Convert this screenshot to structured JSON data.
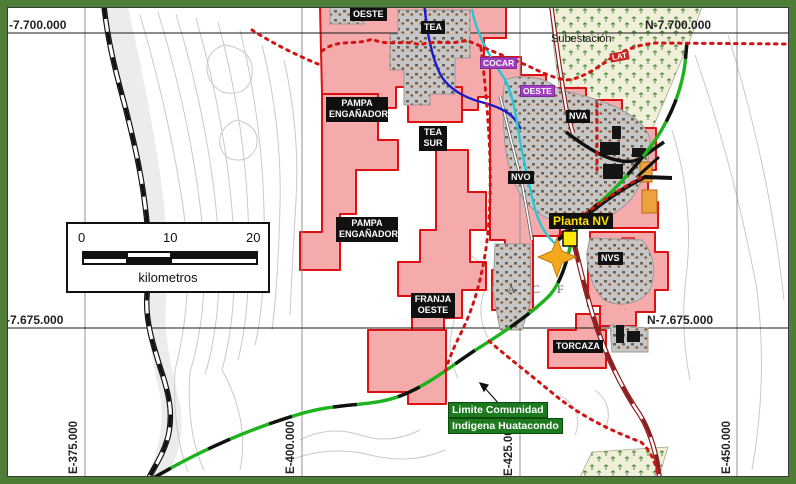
{
  "coordinates": {
    "top_left": "-7.700.000",
    "top_right": "N-7.700.000",
    "mid_left": "-7.675.000",
    "mid_right": "N-7.675.000",
    "east_1": "E-375.000",
    "east_2": "E-400.000",
    "east_3": "E-425.000",
    "east_4": "E-450.000"
  },
  "concessions": {
    "oeste_north": "OESTE",
    "tea": "TEA",
    "cocar": "COCAR",
    "oeste_east": "OESTE",
    "pampa_enganadora_1": "PAMPA ENGAÑADORA",
    "tea_sur": "TEA SUR",
    "pampa_enganadora_2": "PAMPA ENGAÑADORA",
    "franja_oeste": "FRANJA OESTE",
    "nva": "NVA",
    "nvo": "NVO",
    "nvs": "NVS",
    "torcaza": "TORCAZA"
  },
  "places": {
    "bellavista": "BELLAVISTA",
    "subestacion": "Subestación",
    "planta_nv": "Planta NV",
    "lat": "LAT",
    "acf": "A C F"
  },
  "boundary_label": {
    "line1": "Limite Comunidad",
    "line2": "Indigena Huatacondo"
  },
  "scalebar": {
    "ticks": [
      "0",
      "10",
      "20"
    ],
    "unit": "kilometros"
  },
  "colors": {
    "frame_green": "#4e7d38",
    "concession_fill": "#f5abab",
    "concession_border": "#dd1111",
    "boundary_green": "#1db31d",
    "boundary_dotted_red": "#cf1515",
    "star_yellow": "#f4a81d",
    "plant_marker_yellow": "#ffe80a",
    "plant_label_text": "#ffe000",
    "label_purple": "#a13dbf",
    "label_red": "#cf2020",
    "vegetation_fill": "#f0efda",
    "water_cyan": "#29c5d6",
    "water_blue": "#1a1acc",
    "road_darkred": "#8b1a1a"
  }
}
